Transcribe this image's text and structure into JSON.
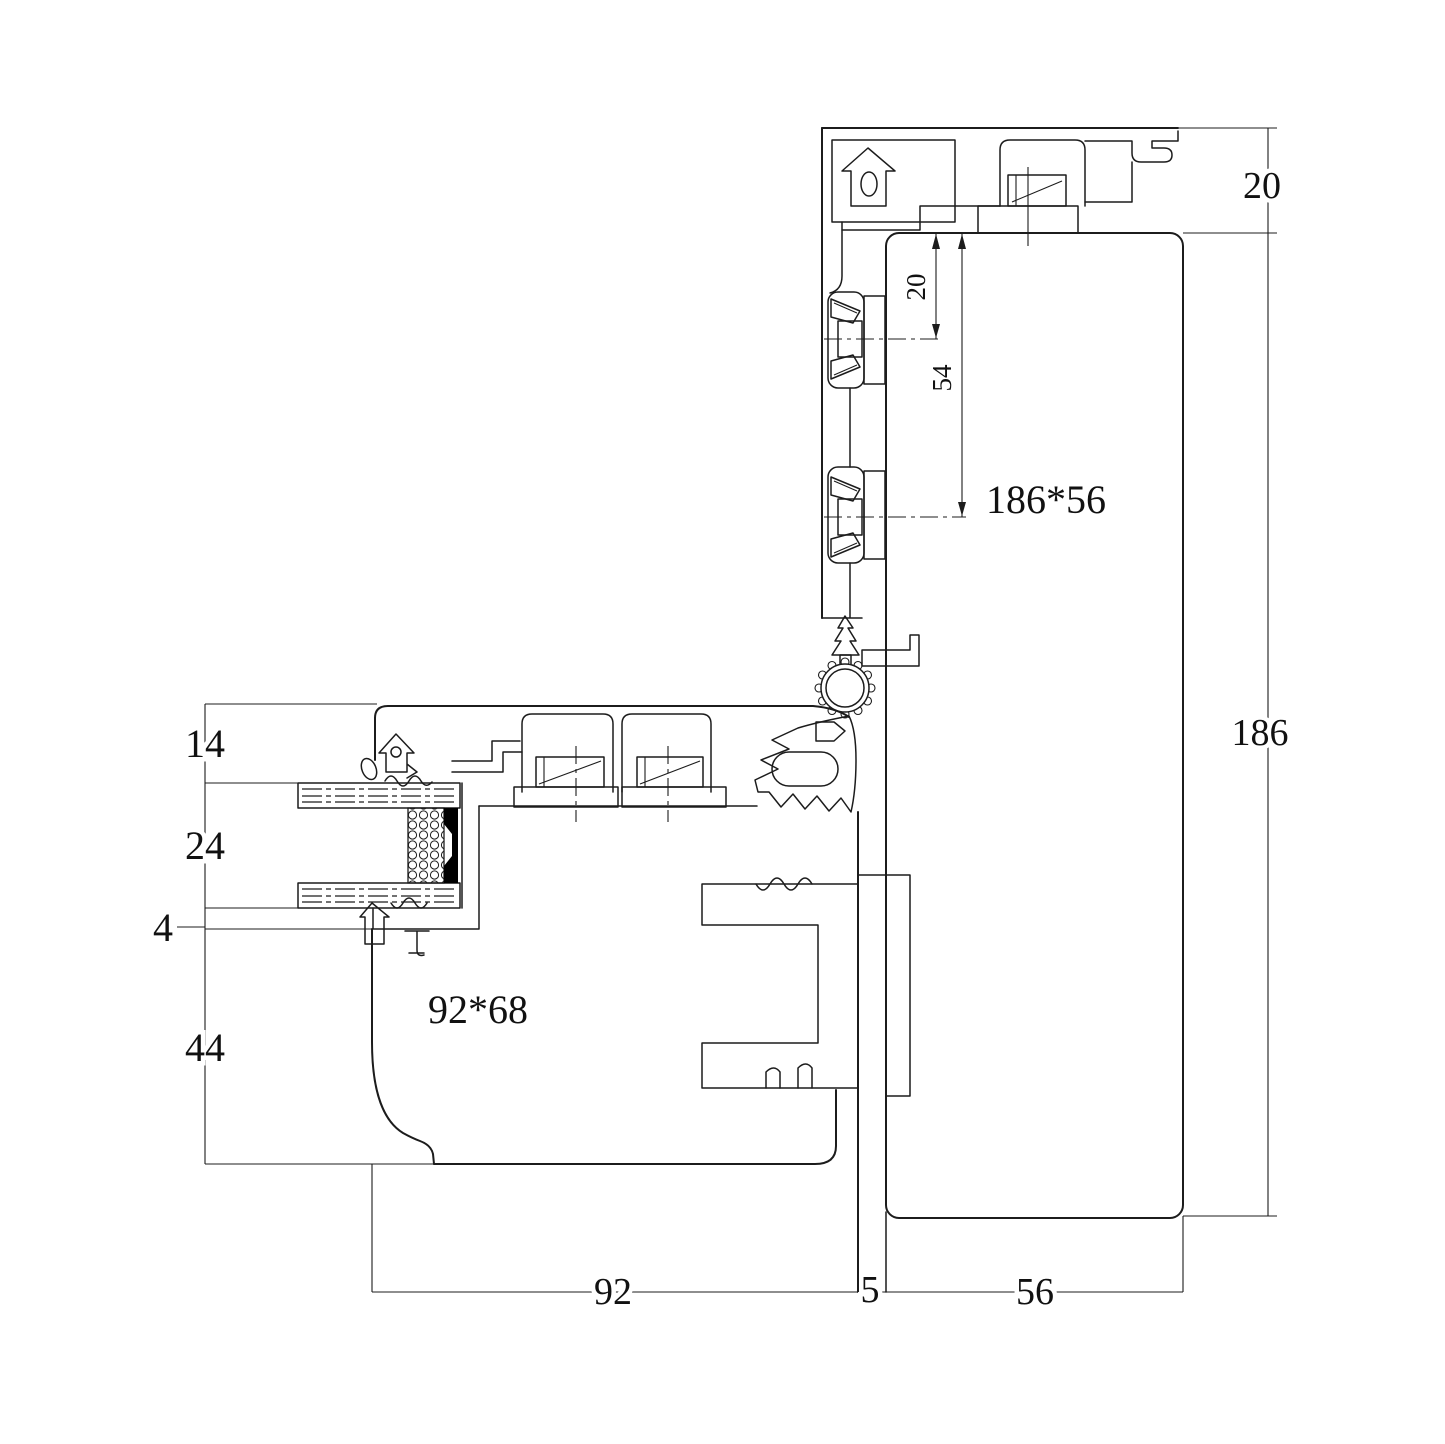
{
  "drawing": {
    "type": "aluminum-window-profile-corner-section",
    "background_color": "#ffffff",
    "line_color": "#1c1c1c",
    "sealant_color": "#000000",
    "labels": {
      "vertical_profile": "186*56",
      "horizontal_profile": "92*68"
    },
    "dims": {
      "right_top": "20",
      "right_main": "186",
      "inner_upper": "20",
      "inner_lower": "54",
      "left_1": "14",
      "left_2": "24",
      "left_3": "4",
      "left_4": "44",
      "bottom_left": "92",
      "bottom_mid": "5",
      "bottom_right": "56"
    }
  }
}
